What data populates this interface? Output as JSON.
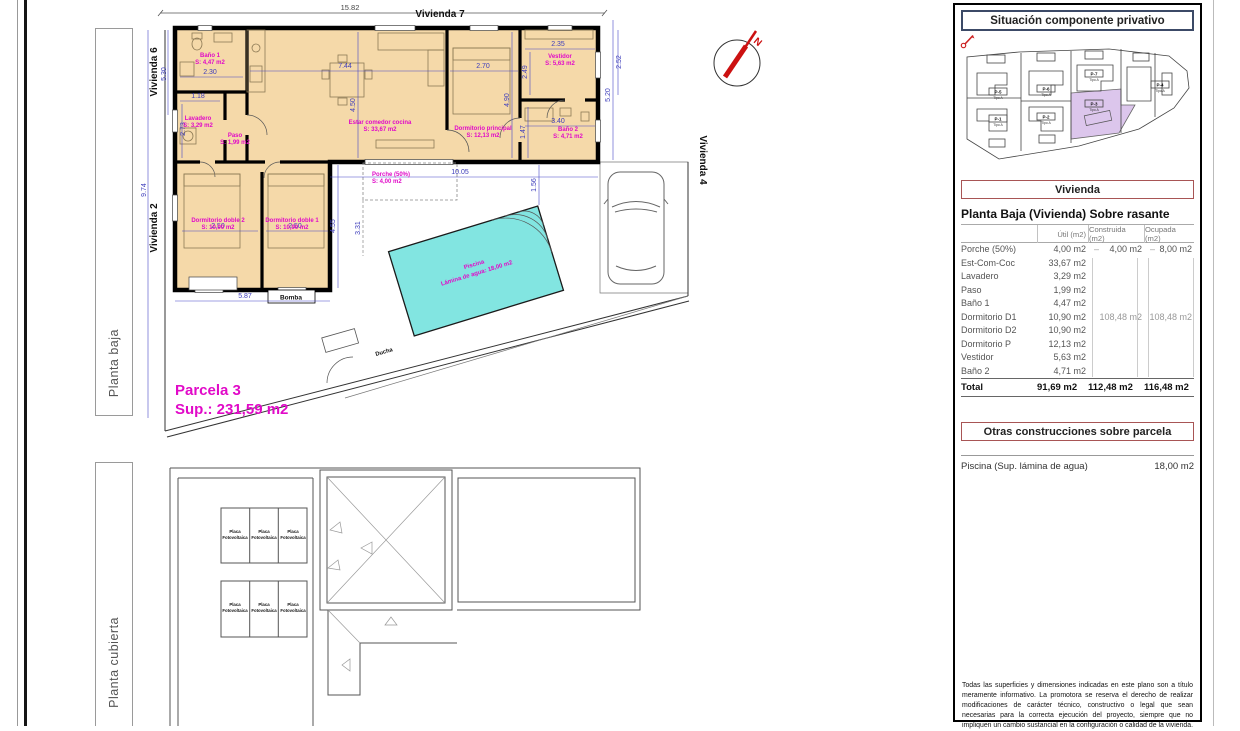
{
  "tabs": {
    "top": "Planta baja",
    "bottom": "Planta cubierta"
  },
  "plan": {
    "viviendas": {
      "top": "Vivienda 7",
      "left_top": "Vivienda 6",
      "left_bottom": "Vivienda 2",
      "right": "Vivienda 4"
    },
    "north": "N",
    "parcel_title": "Parcela 3",
    "parcel_sup": "Sup.: 231,59 m2",
    "rooms": [
      {
        "name": "Baño 1",
        "area": "S: 4,47 m2"
      },
      {
        "name": "Lavadero",
        "area": "S: 3,29 m2"
      },
      {
        "name": "Paso",
        "area": "S: 1,99 m2"
      },
      {
        "name": "Estar comedor cocina",
        "area": "S: 33,67 m2"
      },
      {
        "name": "Dormitorio principal",
        "area": "S: 12,13 m2"
      },
      {
        "name": "Vestidor",
        "area": "S: 5,63 m2"
      },
      {
        "name": "Baño 2",
        "area": "S: 4,71 m2"
      },
      {
        "name": "Dormitorio doble 2",
        "area": "S: 10,90 m2"
      },
      {
        "name": "Dormitorio doble 1",
        "area": "S: 10,90 m2"
      },
      {
        "name": "Porche (50%)",
        "area": "S: 4,00 m2"
      }
    ],
    "pool": {
      "name": "Piscina",
      "area": "Lámina de agua: 18,00 m2"
    },
    "bomba": "Bomba",
    "ducha": "Ducha",
    "dims": {
      "top": "15.82",
      "left": "9.74",
      "left_upper": "5.30",
      "banio1_w": "2.30",
      "lavadero_w": "1.18",
      "lavadero_h": "2.73",
      "salon_w": "7.44",
      "salon_h": "4.50",
      "dormp_w": "2.70",
      "dormp_h": "4.90",
      "vestidor_w": "2.35",
      "vestidor_h": "2.49",
      "right_upper": "2.52",
      "banio2_w": "3.40",
      "banio2_h": "1.47",
      "driveway_h": "5.20",
      "dd2_w": "2.50",
      "dd1_w": "2.50",
      "wing_w": "5.87",
      "wing_h": "4.55",
      "porche_w": "10.05",
      "pool_off": "1.56",
      "porche_h": "3.31"
    }
  },
  "roof": {
    "panel_line1": "Placa",
    "panel_line2": "Fotovoltaica"
  },
  "panel": {
    "title": "Situación componente privativo",
    "site": {
      "parcels": [
        {
          "id": "P-5",
          "tipo": "Tipo A"
        },
        {
          "id": "P-1",
          "tipo": "Tipo A"
        },
        {
          "id": "P-6",
          "tipo": "Tipo A"
        },
        {
          "id": "P-2",
          "tipo": "Tipo A"
        },
        {
          "id": "P-7",
          "tipo": "Tipo A"
        },
        {
          "id": "P-3",
          "tipo": "Tipo A"
        },
        {
          "id": "P-4",
          "tipo": "Tipo A"
        }
      ]
    },
    "vivienda_box": "Vivienda",
    "table_title": "Planta Baja (Vivienda) Sobre rasante",
    "col_headers": [
      "Útil (m2)",
      "Construida (m2)",
      "Ocupada (m2)"
    ],
    "rows": [
      {
        "label": "Porche (50%)",
        "util": "4,00 m2",
        "constr_dash": "–",
        "constr": "4,00 m2",
        "ocup_dash": "–",
        "ocup": "8,00 m2"
      },
      {
        "label": "Est-Com-Coc",
        "util": "33,67 m2"
      },
      {
        "label": "Lavadero",
        "util": "3,29 m2"
      },
      {
        "label": "Paso",
        "util": "1,99 m2"
      },
      {
        "label": "Baño 1",
        "util": "4,47 m2"
      },
      {
        "label": "Dormitorio D1",
        "util": "10,90 m2",
        "constr": "108,48 m2",
        "ocup": "108,48 m2"
      },
      {
        "label": "Dormitorio D2",
        "util": "10,90 m2"
      },
      {
        "label": "Dormitorio P",
        "util": "12,13 m2"
      },
      {
        "label": "Vestidor",
        "util": "5,63 m2"
      },
      {
        "label": "Baño 2",
        "util": "4,71 m2"
      }
    ],
    "total": {
      "label": "Total",
      "util": "91,69 m2",
      "constr": "112,48 m2",
      "ocup": "116,48 m2"
    },
    "otras_box": "Otras construcciones sobre parcela",
    "piscina_label": "Piscina (Sup. lámina de agua)",
    "piscina_value": "18,00 m2",
    "disclaimer": "Todas las superficies y dimensiones indicadas en este plano son a título meramente informativo. La promotora se reserva el derecho de realizar modificaciones de carácter técnico, constructivo o legal que sean necesarias para la correcta ejecución del proyecto, siempre que no impliquen un cambio sustancial en la configuración o calidad de la vivienda."
  }
}
